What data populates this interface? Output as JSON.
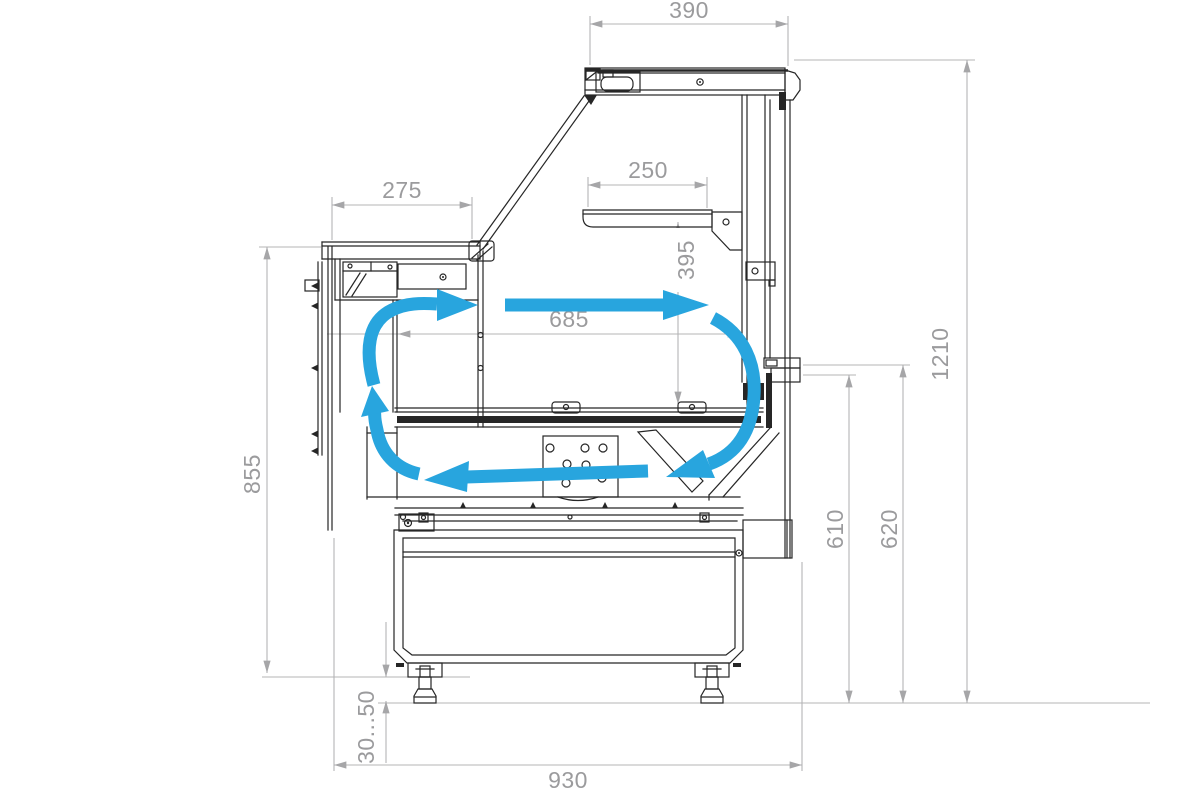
{
  "drawing": {
    "title": "Refrigerated display counter - side cross-section with air circulation",
    "background": "#ffffff",
    "colors": {
      "outline": "#262626",
      "dimension_line": "#b4b4b6",
      "dimension_text": "#9b9b9d",
      "airflow": "#28a5de"
    }
  },
  "dims": {
    "canopy_depth": {
      "label": "390",
      "orientation": "horizontal"
    },
    "worktop_depth": {
      "label": "275",
      "orientation": "horizontal"
    },
    "shelf_depth": {
      "label": "250",
      "orientation": "horizontal"
    },
    "shelf_to_deck_height": {
      "label": "395",
      "orientation": "vertical"
    },
    "interior_depth": {
      "label": "685",
      "orientation": "horizontal"
    },
    "worktop_height": {
      "label": "855",
      "orientation": "vertical"
    },
    "front_lower_height": {
      "label": "610",
      "orientation": "vertical"
    },
    "front_upper_height": {
      "label": "620",
      "orientation": "vertical"
    },
    "overall_height": {
      "label": "1210",
      "orientation": "vertical"
    },
    "foot_adjust_range": {
      "label": "30...50",
      "orientation": "vertical"
    },
    "overall_depth": {
      "label": "930",
      "orientation": "horizontal"
    }
  },
  "airflow": {
    "color": "#28a5de",
    "arrows": [
      "rear-gap-up",
      "duct-exit-curve",
      "chamber-forward",
      "back-wall-down-curve",
      "bottom-return"
    ]
  }
}
